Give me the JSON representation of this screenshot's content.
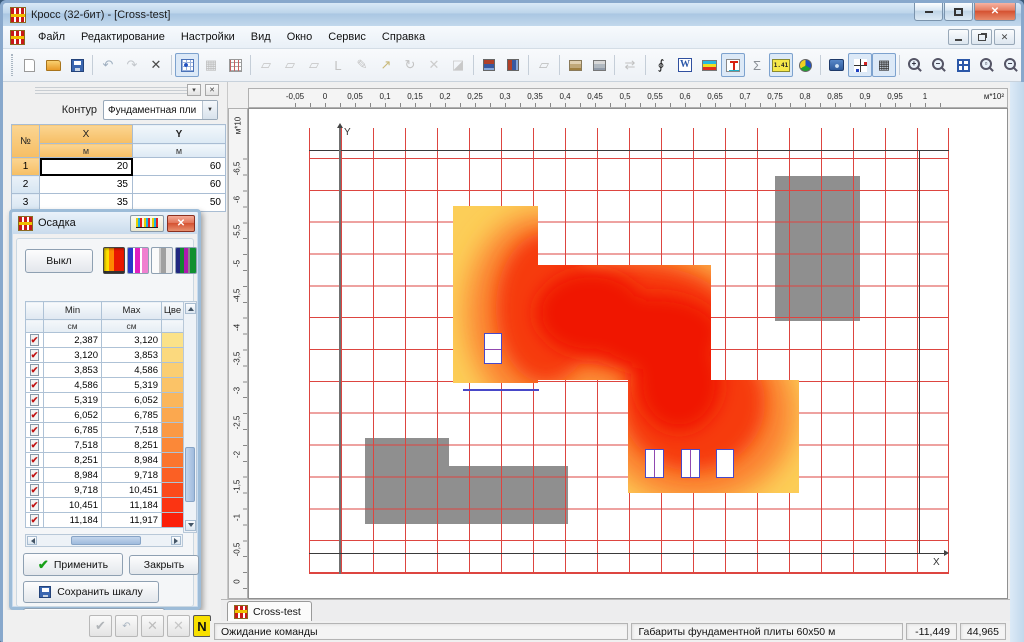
{
  "window": {
    "title": "Кросс (32-бит) - [Cross-test]",
    "close_glyph": "✕"
  },
  "menu": {
    "items": [
      "Файл",
      "Редактирование",
      "Настройки",
      "Вид",
      "Окно",
      "Сервис",
      "Справка"
    ]
  },
  "toolbar": {
    "buttons": [
      {
        "name": "new-document",
        "type": "page"
      },
      {
        "name": "open-file",
        "type": "folder"
      },
      {
        "name": "save",
        "type": "save"
      },
      {
        "sep": true
      },
      {
        "name": "undo",
        "glyph": "↶",
        "color": "#9FAFC0"
      },
      {
        "name": "redo",
        "glyph": "↷",
        "color": "#C3C7CC"
      },
      {
        "name": "delete",
        "glyph": "✕",
        "color": "#4a4a4a"
      },
      {
        "sep": true
      },
      {
        "name": "fragment-grid",
        "type": "table",
        "pressed": true
      },
      {
        "name": "grid-info",
        "glyph": "▦",
        "color": "#BDBDBD"
      },
      {
        "name": "grid-numbers",
        "type": "gridnum"
      },
      {
        "sep": true
      },
      {
        "name": "copy-fragment",
        "glyph": "▱",
        "color": "#C3C3C3"
      },
      {
        "name": "paste-fragment",
        "glyph": "▱",
        "color": "#C3C3C3"
      },
      {
        "name": "insert-fragment",
        "glyph": "▱",
        "color": "#C3C3C3"
      },
      {
        "name": "rotate-left",
        "glyph": "L",
        "color": "#C3C3C3"
      },
      {
        "name": "edit-contour",
        "glyph": "✎",
        "color": "#C3C3C3"
      },
      {
        "name": "move-node",
        "glyph": "↗",
        "color": "#C8B878"
      },
      {
        "name": "rotate-fragment",
        "glyph": "↻",
        "color": "#C3C3C3"
      },
      {
        "name": "delete-node",
        "glyph": "✕",
        "color": "#CCCCCC"
      },
      {
        "name": "eraser",
        "glyph": "◪",
        "color": "#C9C9C9"
      },
      {
        "sep": true
      },
      {
        "name": "section-front",
        "type": "sec1"
      },
      {
        "name": "section-side",
        "type": "sec2"
      },
      {
        "sep": true
      },
      {
        "name": "plate-copy",
        "glyph": "▱",
        "color": "#B9B9B9"
      },
      {
        "sep": true
      },
      {
        "name": "soil-table",
        "type": "soil"
      },
      {
        "name": "soil-report",
        "type": "soil2"
      },
      {
        "sep": true
      },
      {
        "name": "update-model",
        "glyph": "⇄",
        "color": "#C0C0C0"
      },
      {
        "sep": true
      },
      {
        "name": "integral",
        "glyph": "∮",
        "color": "#151515"
      },
      {
        "name": "export-word",
        "type": "word",
        "glyph": "W"
      },
      {
        "name": "soil-layers",
        "type": "layers"
      },
      {
        "name": "pile-load",
        "type": "pile",
        "pressed": true
      },
      {
        "name": "sum",
        "glyph": "Σ",
        "color": "#8A8F96"
      },
      {
        "name": "calculator",
        "type": "calc",
        "glyph": "1.41",
        "pressed": true
      },
      {
        "name": "color-palette",
        "type": "pie"
      },
      {
        "sep": true
      },
      {
        "name": "snapshot-settings",
        "type": "cam"
      },
      {
        "name": "show-axes",
        "type": "axes",
        "pressed": true
      },
      {
        "name": "show-mesh",
        "glyph": "▦",
        "color": "#333333",
        "pressed": true
      },
      {
        "sep": true
      },
      {
        "name": "zoom-in",
        "type": "zoom",
        "z": "+"
      },
      {
        "name": "zoom-out",
        "type": "zoom",
        "z": "–"
      },
      {
        "name": "zoom-window",
        "type": "zrect"
      },
      {
        "name": "zoom-region",
        "type": "zoom",
        "z": "▫"
      },
      {
        "name": "zoom-previous",
        "type": "zoom",
        "z": "−"
      },
      {
        "name": "zoom-all",
        "type": "zoom",
        "z": "≡"
      }
    ]
  },
  "left_panel": {
    "collapse_glyph": "▾",
    "close_glyph": "✕",
    "contour_label": "Контур",
    "contour_value": "Фундаментная пли",
    "table": {
      "num_header": "№",
      "x_header": "X",
      "y_header": "Y",
      "unit": "м",
      "rows": [
        {
          "n": "1",
          "x": "20",
          "y": "60"
        },
        {
          "n": "2",
          "x": "35",
          "y": "60"
        },
        {
          "n": "3",
          "x": "35",
          "y": "50"
        }
      ]
    },
    "footer_buttons": [
      {
        "name": "apply",
        "glyph": "✔",
        "color": "#B0B4B8"
      },
      {
        "name": "undo",
        "glyph": "↶",
        "color": "#A8B4C0",
        "small": true
      },
      {
        "name": "cancel",
        "glyph": "✕",
        "color": "#BDBDBD"
      },
      {
        "name": "delete",
        "glyph": "✕",
        "color": "#C6C6C6"
      },
      {
        "name": "numbering",
        "glyph": "N",
        "color": "#111111",
        "bg": "#F8E000",
        "border": "#555555"
      }
    ]
  },
  "dialog": {
    "title": "Осадка",
    "close_glyph": "✕",
    "off_button": "Выкл",
    "table": {
      "min_header": "Min",
      "max_header": "Max",
      "color_header": "Цве",
      "unit": "см",
      "check_glyph": "✔",
      "rows": [
        {
          "min": "2,387",
          "max": "3,120",
          "color": "#FBE289"
        },
        {
          "min": "3,120",
          "max": "3,853",
          "color": "#FBD97E"
        },
        {
          "min": "3,853",
          "max": "4,586",
          "color": "#FBCE72"
        },
        {
          "min": "4,586",
          "max": "5,319",
          "color": "#FBC367"
        },
        {
          "min": "5,319",
          "max": "6,052",
          "color": "#FBB65B"
        },
        {
          "min": "6,052",
          "max": "6,785",
          "color": "#FBA84F"
        },
        {
          "min": "6,785",
          "max": "7,518",
          "color": "#FB9944"
        },
        {
          "min": "7,518",
          "max": "8,251",
          "color": "#FB8838"
        },
        {
          "min": "8,251",
          "max": "8,984",
          "color": "#FB752E"
        },
        {
          "min": "8,984",
          "max": "9,718",
          "color": "#FB6024"
        },
        {
          "min": "9,718",
          "max": "10,451",
          "color": "#FB4A1B"
        },
        {
          "min": "10,451",
          "max": "11,184",
          "color": "#FB3412"
        },
        {
          "min": "11,184",
          "max": "11,917",
          "color": "#FB1F09"
        }
      ]
    },
    "apply_button": "Применить",
    "apply_check": "✔",
    "close_button": "Закрыть",
    "save_button": "Сохранить шкалу",
    "restore_button": "Восстановить шкалу"
  },
  "canvas": {
    "ruler_top": {
      "labels": [
        "-0,05",
        "0",
        "0,05",
        "0,1",
        "0,15",
        "0,2",
        "0,25",
        "0,3",
        "0,35",
        "0,4",
        "0,45",
        "0,5",
        "0,55",
        "0,6",
        "0,65",
        "0,7",
        "0,75",
        "0,8",
        "0,85",
        "0,9",
        "0,95",
        "1"
      ],
      "unit": "м*10²"
    },
    "ruler_left": {
      "labels_bottom_to_top": [
        "0",
        "-0,5",
        "-1",
        "-1,5",
        "-2",
        "-2,5",
        "-3",
        "-3,5",
        "-4",
        "-4,5",
        "-5",
        "-5,5",
        "-6",
        "-6,5"
      ],
      "unit": "м*10"
    },
    "axis_x_label": "X",
    "axis_y_label": "Y",
    "grid_color": "#DD4540",
    "heat_colors": {
      "edge": "#FCCE58",
      "mid": "#FB8430",
      "hot": "#F63B10",
      "core": "#F01505"
    }
  },
  "tabs": {
    "active": "Cross-test"
  },
  "status": {
    "message": "Ожидание команды",
    "info": "Габариты фундаментной плиты 60x50 м",
    "coord_x": "-11,449",
    "coord_y": "44,965"
  }
}
